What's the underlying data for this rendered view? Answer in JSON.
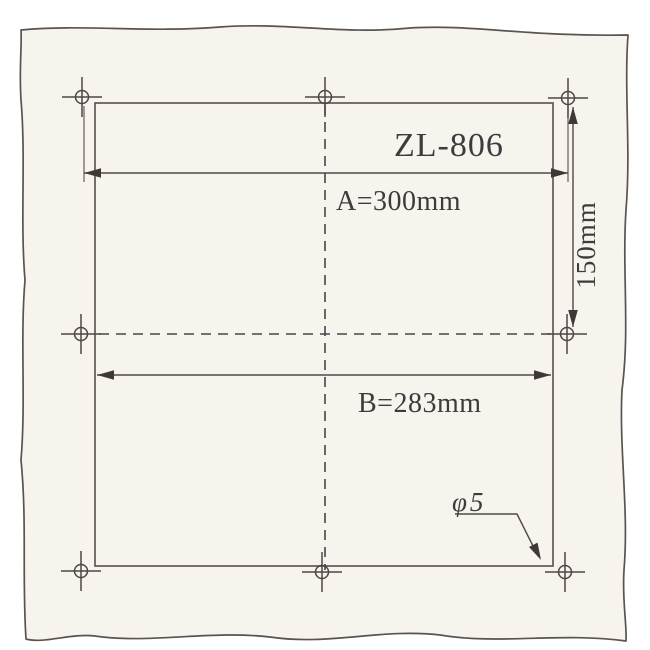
{
  "drawing": {
    "model_label": "ZL-806",
    "dim_a_label": "A=300mm",
    "dim_b_label": "B=283mm",
    "dim_side_label": "150mm",
    "hole_callout": "φ5"
  },
  "colors": {
    "paper": "#f7f4ee",
    "ink": "#4f4a48",
    "text": "#3e3a3e",
    "background": "#ffffff"
  }
}
